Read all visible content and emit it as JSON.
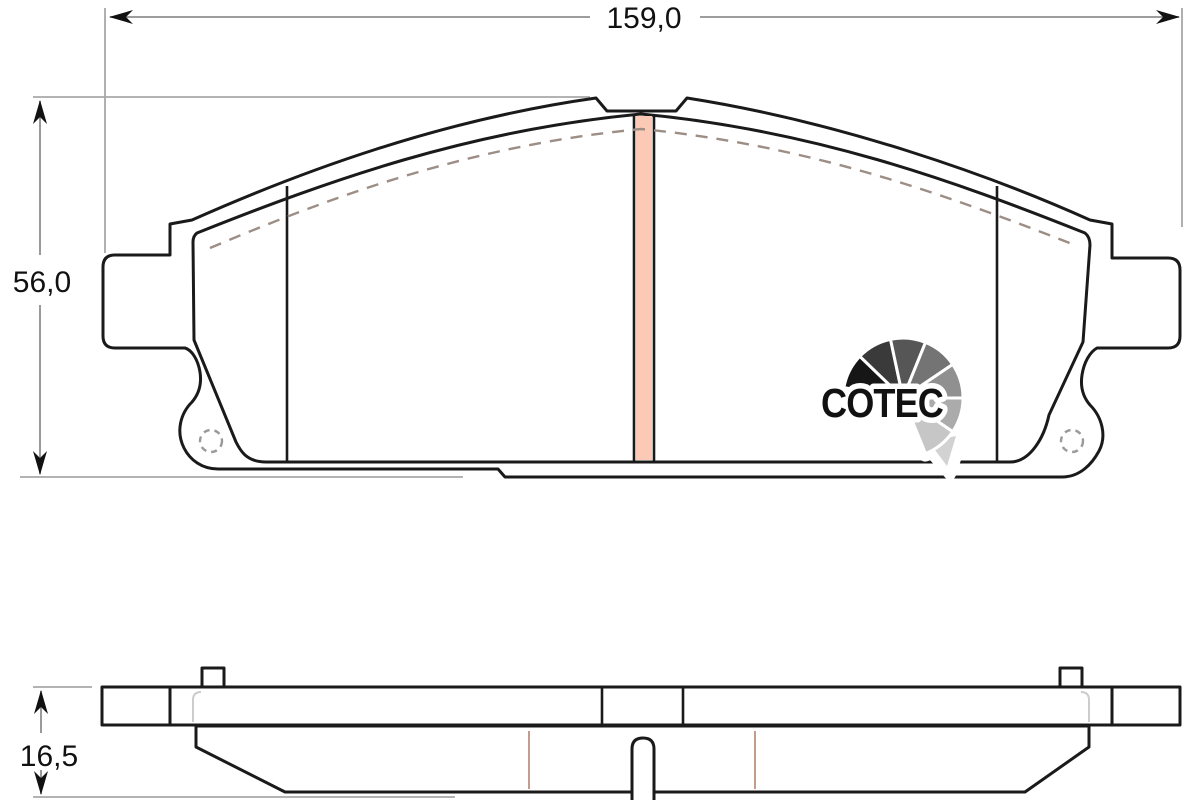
{
  "diagram": {
    "title_logo": "COTEC",
    "dimensions": {
      "width": {
        "label": "159,0"
      },
      "height": {
        "label": "56,0"
      },
      "thickness": {
        "label": "16,5"
      }
    },
    "logo": {
      "text": "COTEC",
      "segment_colors": [
        "#161616",
        "#3a3a3a",
        "#565656",
        "#747474",
        "#909090",
        "#ababab",
        "#c6c6c6"
      ],
      "tail_color": "#d2d2d2"
    },
    "colors": {
      "friction_material": "#f8bba4",
      "friction_slot": "#fbc9b5",
      "backplate": "#ffffff",
      "outline": "#1a1a1a"
    }
  }
}
